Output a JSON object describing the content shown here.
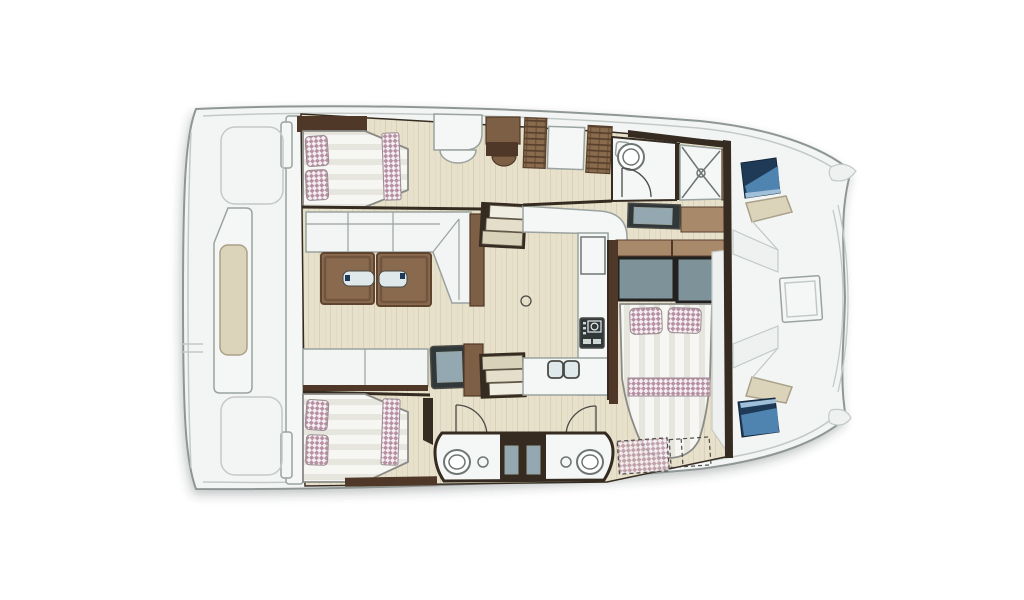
{
  "figure": {
    "kind": "boat-floor-plan",
    "vessel": "sailing-catamaran",
    "view": "top-down-interior-layout",
    "bow_direction": "right",
    "stern_direction": "left"
  },
  "elements": [
    {
      "name": "hull-outline"
    },
    {
      "name": "aft-platform"
    },
    {
      "name": "aft-bench"
    },
    {
      "name": "port-aft-cabin-double-bed"
    },
    {
      "name": "port-hull-wardrobes"
    },
    {
      "name": "port-bathroom-toilet"
    },
    {
      "name": "port-shower"
    },
    {
      "name": "salon-l-sofa"
    },
    {
      "name": "salon-folding-table"
    },
    {
      "name": "salon-bench"
    },
    {
      "name": "salon-side-table"
    },
    {
      "name": "companionway-stairs-port"
    },
    {
      "name": "companionway-stairs-starboard"
    },
    {
      "name": "galley-counter"
    },
    {
      "name": "galley-stove"
    },
    {
      "name": "galley-double-sink"
    },
    {
      "name": "starboard-aft-cabin-double-bed"
    },
    {
      "name": "starboard-bathroom-port-side"
    },
    {
      "name": "starboard-bathroom-forward"
    },
    {
      "name": "forward-cabin-double-bed"
    },
    {
      "name": "forward-cabin-headboard"
    },
    {
      "name": "optional-forepeak-berth"
    },
    {
      "name": "foredeck-lounge"
    },
    {
      "name": "foredeck-hatch-port"
    },
    {
      "name": "foredeck-hatch-starboard"
    },
    {
      "name": "bow-tip-port"
    },
    {
      "name": "bow-tip-starboard"
    }
  ],
  "counts": {
    "double-beds": 3,
    "toilets": 3,
    "showers": 1,
    "door-swings": 3
  },
  "palette": {
    "bg": "#ffffff",
    "hull-fill": "#f3f5f4",
    "hull-stroke": "#8f9795",
    "inner-line": "#c3cac6",
    "deck-facet": "#eef1ef",
    "floor": "#e7e0ca",
    "floor-grain": "#d9d1b7",
    "wall-dark": "#352b21",
    "line-dark": "#4a4a46",
    "room-white": "#f4f7f5",
    "furn-stroke": "#9aa39f",
    "sofa-white": "#f2f5f3",
    "bed-stroke": "#8a8a86",
    "duvet": "#f6f6f3",
    "duvet-stripe": "#e6e6df",
    "checker-base": "#f4eef1",
    "checker-accent": "#b791a3",
    "checker-stroke": "#9a8b92",
    "wicker-base": "#8a6b4d",
    "wicker-dark": "#57402c",
    "wood-mid": "#7d5f45",
    "wood-dark": "#4f3827",
    "wood-light": "#a8896a",
    "table-wood": "#8a6a4e",
    "table-wood-dark": "#5f4430",
    "glass": "#dfe8ea",
    "slate": "#7e929a",
    "slate-frame": "#22211f",
    "dark-unit": "#30383a",
    "dark-unit-inner": "#93a8b0",
    "navy": "#1e3a56",
    "navy-dark": "#13263a",
    "navy-light": "#4f83b0",
    "navy-pale": "#9fc0d8",
    "beige-cushion": "#dcd4ba",
    "beige-stroke": "#a9a188",
    "fixture-stroke": "#6e7673",
    "stair-light": "#f0ede2",
    "stair-mid": "#e4decb",
    "stair-dark": "#d9d2ba",
    "stair-edge": "#6b6352"
  }
}
